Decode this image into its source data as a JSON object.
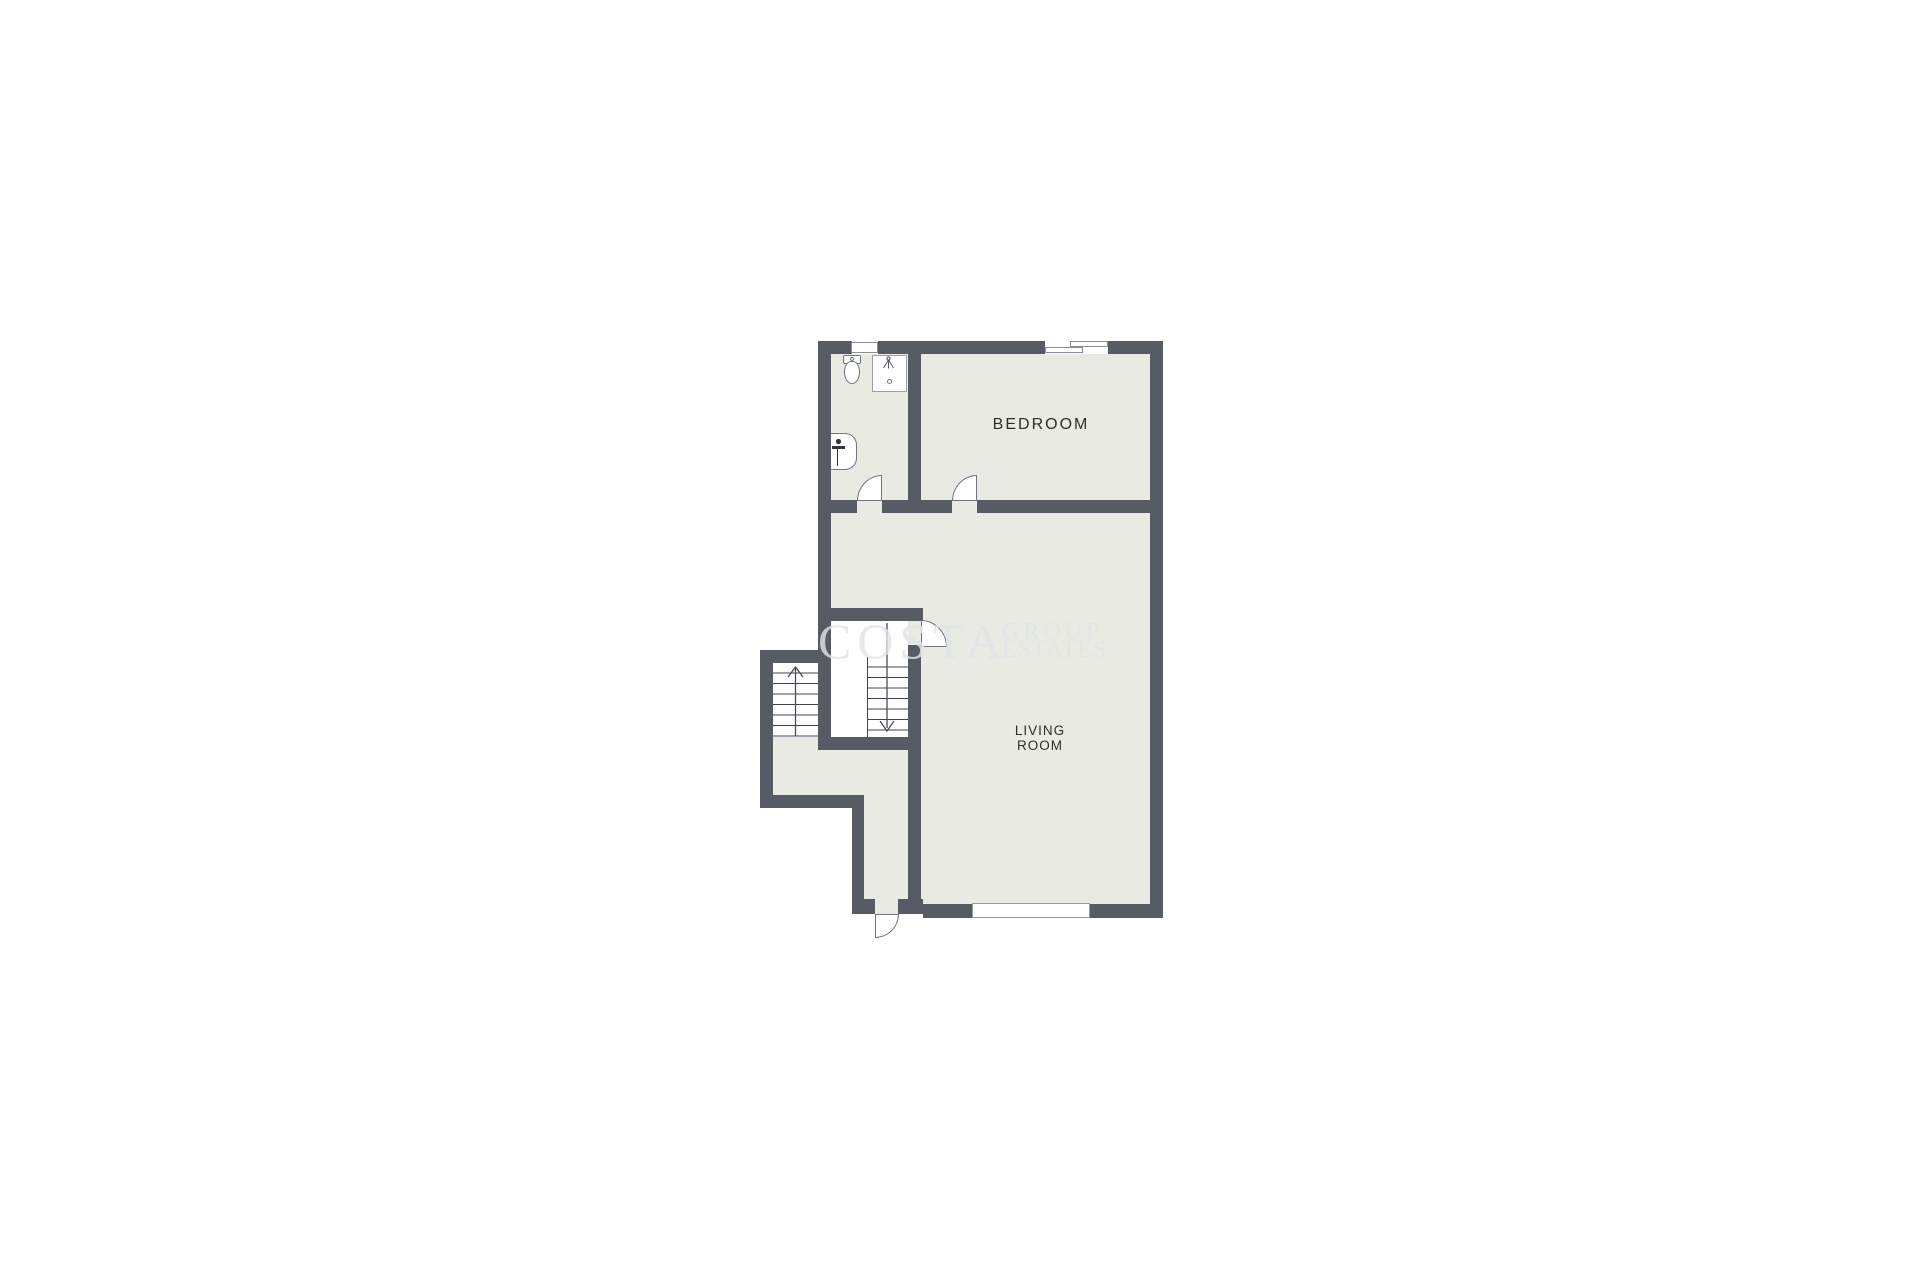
{
  "page": {
    "background": "#ffffff"
  },
  "floorplan": {
    "colors": {
      "wall": "#575c64",
      "floor": "#e9ebe3",
      "tread": "#3f444c",
      "label": "#2e2e2e",
      "outline": "#70757e"
    },
    "rooms": {
      "bedroom": {
        "label": "BEDROOM"
      },
      "living": {
        "line1": "LIVING",
        "line2": "ROOM"
      }
    },
    "watermark": {
      "line1": "COSTA",
      "line2": "GROUP",
      "line3": "ESTATES"
    },
    "stairs": {
      "up_flight": {
        "direction": "up",
        "steps": 7
      },
      "down_flight": {
        "direction": "down",
        "steps": 7
      }
    },
    "fixtures": [
      "toilet",
      "shower",
      "sink"
    ],
    "windows_count": 3,
    "doors_count": 4
  }
}
